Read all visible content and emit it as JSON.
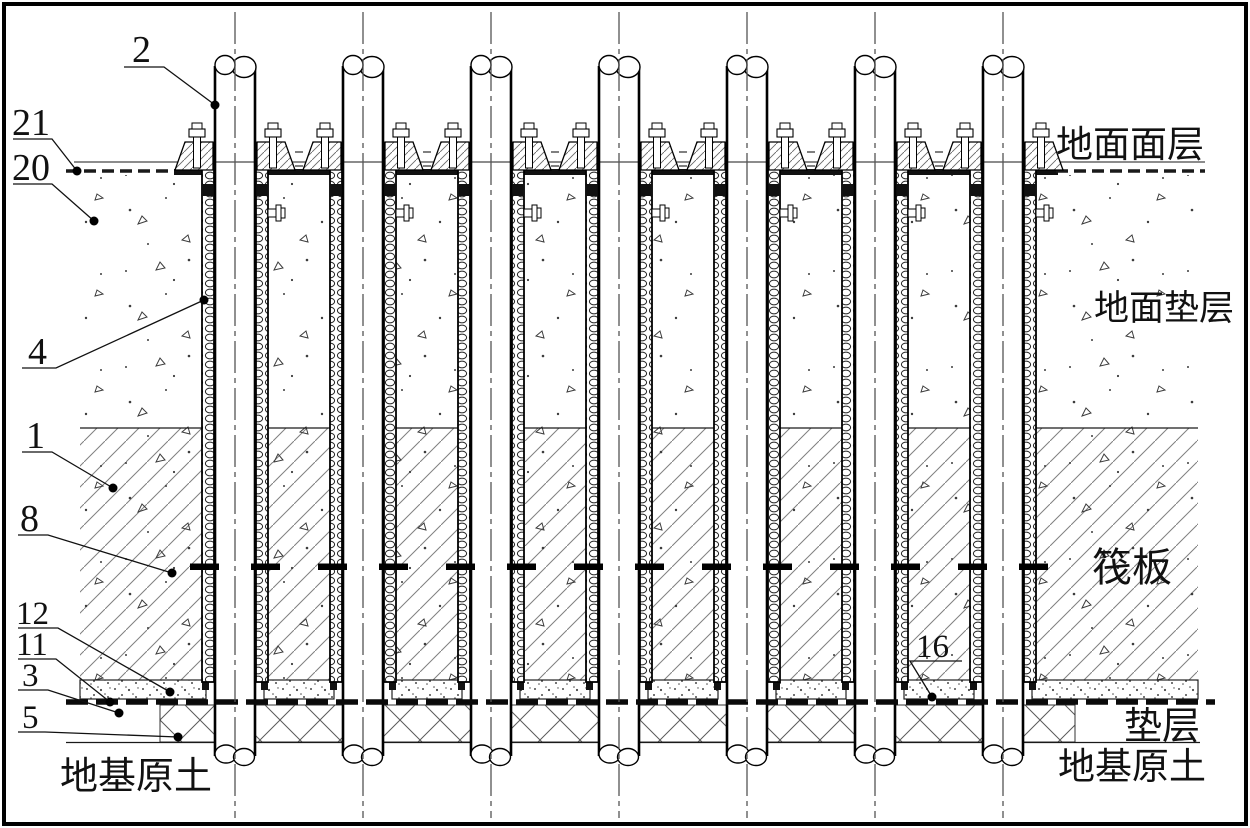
{
  "drawing": {
    "callouts": {
      "c2": "2",
      "c21": "21",
      "c20": "20",
      "c4": "4",
      "c1": "1",
      "c8": "8",
      "c12": "12",
      "c11": "11",
      "c3": "3",
      "c5": "5",
      "c16": "16"
    },
    "labels": {
      "ground_surface": "地面面层",
      "ground_cushion": "地面垫层",
      "raft": "筏板",
      "cushion": "垫层",
      "soil_left": "地基原土",
      "soil_right": "地基原土"
    },
    "colors": {
      "ink": "#1a1a1a",
      "paper": "#ffffff",
      "hatch": "#787878"
    }
  }
}
